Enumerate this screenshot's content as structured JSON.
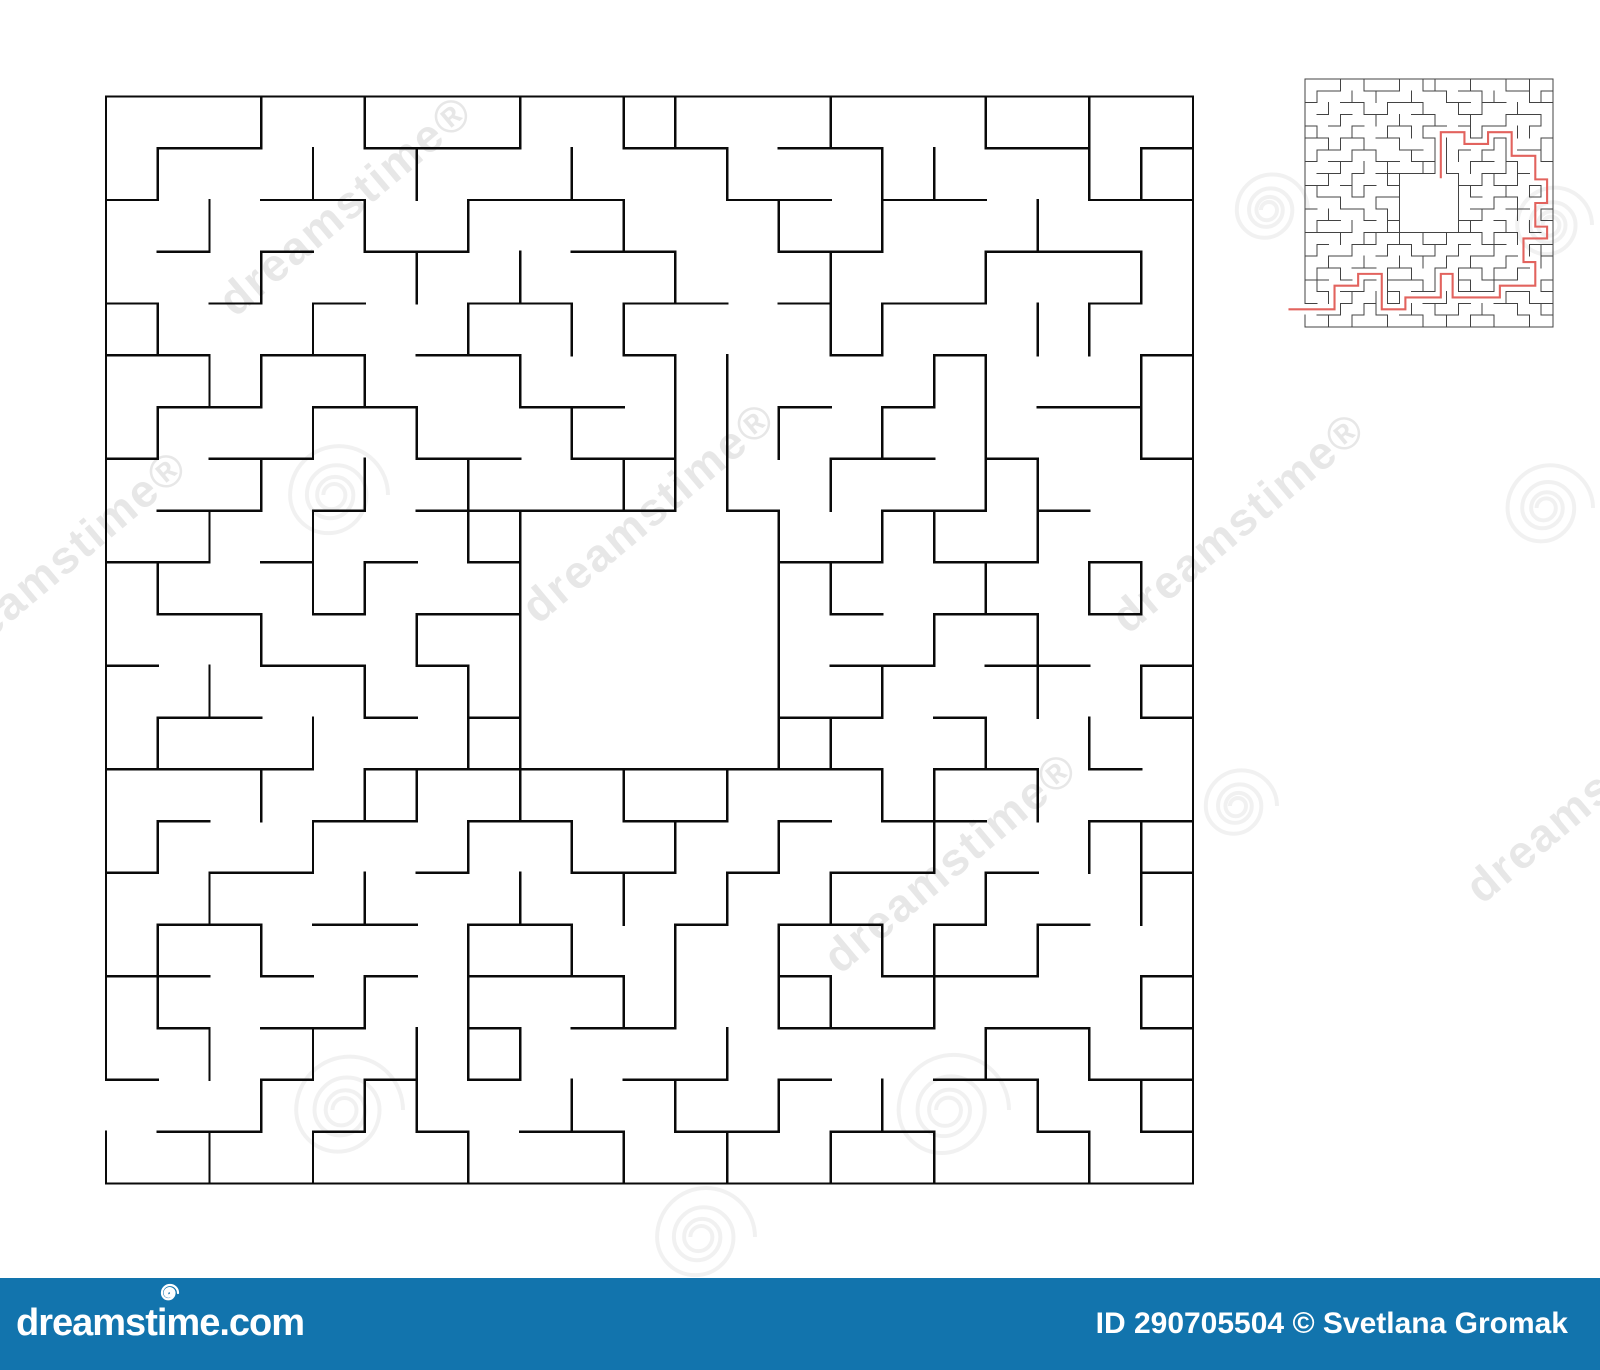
{
  "image": {
    "description": "Square maze puzzle with central goal room, with small solved answer-key maze in top right corner",
    "background": "#ffffff"
  },
  "maze": {
    "rows": 21,
    "cols": 21,
    "entrance_row": 19,
    "center_room": {
      "col": 8,
      "row": 8,
      "size": 5,
      "opening_col": 11
    },
    "large_wall_color": "#0a0a0a",
    "small_wall_color": "#434343",
    "h_walls": [
      "111111111111111111111",
      "011001110011011001101",
      "100110011100110110011",
      "010101100110011001110",
      "101010011011010110010",
      "110110110010001010001",
      "011011001100010100110",
      "101100110110001101001",
      "011010111110100110100",
      "110101010000011011010",
      "011010110000001011010",
      "100110100000001101101",
      "011001010000011010001",
      "111101111111111011010",
      "010011011011010110011",
      "101100100110101101001",
      "011011011001011010100",
      "110101011100010111001",
      "010110010110011101101",
      "100101010011010011011",
      "011010101101101100101",
      "111111111111111111111"
    ],
    "v_walls": [
      "1001010010110010010101",
      "1100101001001001100111",
      "1010010100100101001001",
      "1001001010010010010011",
      "1100100101100011001101",
      "1011010010011000110011",
      "1100101001011101010011",
      "1001010100111010011001",
      "1010100110000101101001",
      "1100110010000110010111",
      "1001001010000100101001",
      "1010010110000101001011",
      "1100100110000110010101",
      "1001011010101001101001",
      "1100100101010100100111",
      "1010010010101010010011",
      "1101000101010101101001",
      "1100010100110110100011",
      "1010101110001000010101",
      "0001011001010101001011",
      "1010100100101010100101"
    ]
  },
  "solution": {
    "color": "#e2635e",
    "path": [
      [
        -1.4,
        19.5
      ],
      [
        2.5,
        19.5
      ],
      [
        2.5,
        17.5
      ],
      [
        4.5,
        17.5
      ],
      [
        4.5,
        16.5
      ],
      [
        6.5,
        16.5
      ],
      [
        6.5,
        19.5
      ],
      [
        8.5,
        19.5
      ],
      [
        8.5,
        18.5
      ],
      [
        11.5,
        18.5
      ],
      [
        11.5,
        16.5
      ],
      [
        12.5,
        16.5
      ],
      [
        12.5,
        18.5
      ],
      [
        16.5,
        18.5
      ],
      [
        16.5,
        17.5
      ],
      [
        19.5,
        17.5
      ],
      [
        19.5,
        15.5
      ],
      [
        18.5,
        15.5
      ],
      [
        18.5,
        13.5
      ],
      [
        20.5,
        13.5
      ],
      [
        20.5,
        12.5
      ],
      [
        19.5,
        12.5
      ],
      [
        19.5,
        10.5
      ],
      [
        20.5,
        10.5
      ],
      [
        20.5,
        8.5
      ],
      [
        19.5,
        8.5
      ],
      [
        19.5,
        6.5
      ],
      [
        17.5,
        6.5
      ],
      [
        17.5,
        4.5
      ],
      [
        15.5,
        4.5
      ],
      [
        15.5,
        5.5
      ],
      [
        13.5,
        5.5
      ],
      [
        13.5,
        4.5
      ],
      [
        11.5,
        4.5
      ],
      [
        11.5,
        8.4
      ]
    ]
  },
  "watermarks": {
    "text": "dreamstime",
    "suffix": "®",
    "text_color": "rgba(0,0,0,0.095)",
    "spiral_color": "rgba(0,0,0,0.055)",
    "angle_deg": -40,
    "texts": [
      {
        "x": 345,
        "y": 205
      },
      {
        "x": 648,
        "y": 512
      },
      {
        "x": 60,
        "y": 560
      },
      {
        "x": 950,
        "y": 862
      },
      {
        "x": 1238,
        "y": 522
      },
      {
        "x": 1592,
        "y": 792
      }
    ],
    "spirals": [
      {
        "x": 333,
        "y": 495,
        "r": 55
      },
      {
        "x": 343,
        "y": 1110,
        "r": 60
      },
      {
        "x": 947,
        "y": 1110,
        "r": 62
      },
      {
        "x": 700,
        "y": 1237,
        "r": 55
      },
      {
        "x": 1268,
        "y": 210,
        "r": 40
      },
      {
        "x": 1550,
        "y": 225,
        "r": 42
      },
      {
        "x": 1545,
        "y": 508,
        "r": 48
      },
      {
        "x": 1237,
        "y": 806,
        "r": 40
      }
    ]
  },
  "footer": {
    "bar_color": "#1274ad",
    "text_color": "#ffffff",
    "logo_text": "dreamstime.com",
    "credit_text": "ID 290705504 © Svetlana Gromak"
  }
}
